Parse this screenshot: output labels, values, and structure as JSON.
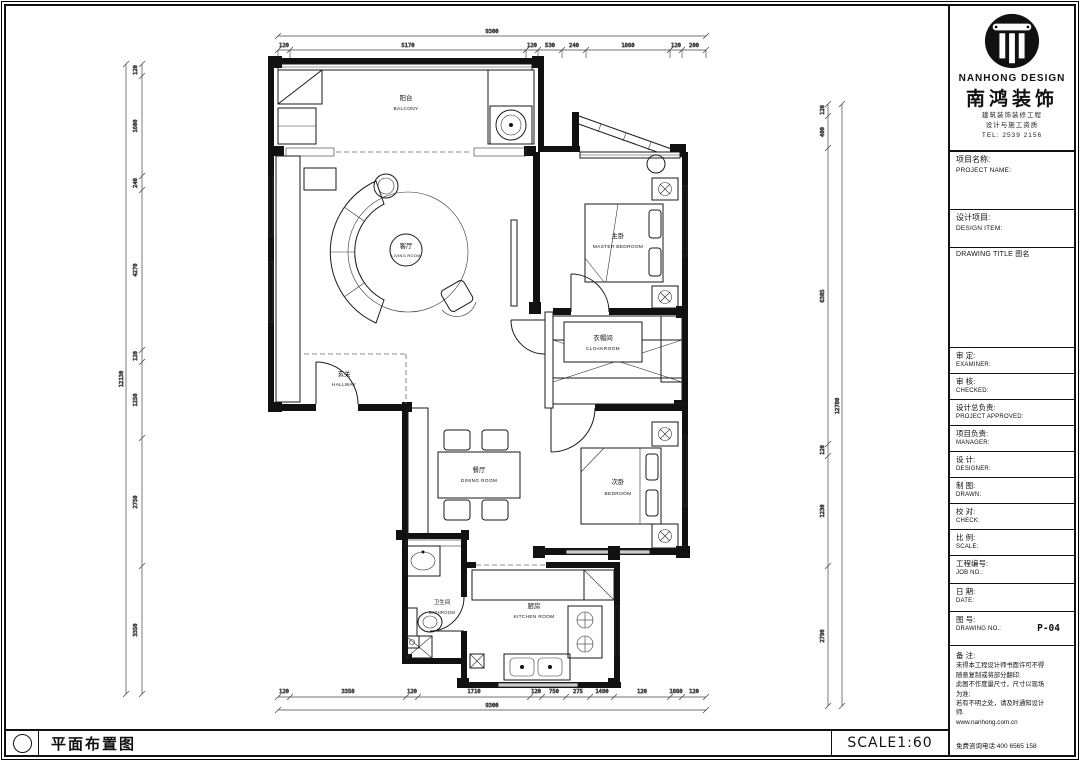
{
  "footer": {
    "drawing_title": "平面布置图",
    "scale": "SCALE1:60"
  },
  "brand": {
    "name_en": "NANHONG DESIGN",
    "name_cn": "南鸿装饰",
    "line1": "建筑装饰装修工程",
    "line2": "设计与施工资质",
    "line3": "TEL: 2539 2156"
  },
  "title_block": {
    "project_cn": "项目名称:",
    "project_en": "PROJECT NAME:",
    "design_cn": "设计项目:",
    "design_en": "DESIGN ITEM:",
    "drawing_title_label": "DRAWING TITLE 图名",
    "rows": [
      {
        "cn": "审  定:",
        "en": "EXAMINER:"
      },
      {
        "cn": "审  核:",
        "en": "CHECKED:"
      },
      {
        "cn": "设计总负责:",
        "en": "PROJECT APPROVED:"
      },
      {
        "cn": "项目负责:",
        "en": "MANAGER:"
      },
      {
        "cn": "设  计:",
        "en": "DESIGNER:"
      },
      {
        "cn": "制  图:",
        "en": "DRAWN:"
      },
      {
        "cn": "校  对:",
        "en": "CHECK:"
      },
      {
        "cn": "比  例:",
        "en": "SCALE:"
      },
      {
        "cn": "工程编号:",
        "en": "JOB NO.:"
      },
      {
        "cn": "日  期:",
        "en": "DATE:"
      },
      {
        "cn": "图  号:",
        "en": "DRAWING NO.:",
        "value": "P-04"
      }
    ],
    "notes_label": "备  注:",
    "notes": [
      "未得本工程设计师书面许可不得",
      "随意复制或将部分翻印;",
      "此图不作度量尺寸，尺寸以现场",
      "为准;",
      "若有不明之处，请及时通知设计",
      "师.",
      "www.nanhong.com.cn"
    ],
    "hotline": "免费咨询电话:400 6565 158"
  },
  "rooms": {
    "balcony": {
      "cn": "阳台",
      "en": "BALCONY"
    },
    "living": {
      "cn": "客厅",
      "en": "LIVING ROOM"
    },
    "master": {
      "cn": "主卧",
      "en": "MASTER BEDROOM"
    },
    "cloak": {
      "cn": "衣帽间",
      "en": "CLOAKROOM"
    },
    "hall": {
      "cn": "玄关",
      "en": "HALLWAY"
    },
    "dining": {
      "cn": "餐厅",
      "en": "DINING ROOM"
    },
    "bedroom": {
      "cn": "次卧",
      "en": "BEDROOM"
    },
    "bath": {
      "cn": "卫生间",
      "en": "BATHROOM"
    },
    "kitchen": {
      "cn": "厨房",
      "en": "KITCHEN ROOM"
    }
  },
  "dims": {
    "top": {
      "total": "9300",
      "segs": [
        "120",
        "5170",
        "120",
        "530",
        "240",
        "1860",
        "120",
        "200"
      ]
    },
    "bottom": {
      "total": "9300",
      "segs": [
        "120",
        "3350",
        "120",
        "1710",
        "120",
        "750",
        "275",
        "1490",
        "120",
        "1860",
        "120"
      ]
    },
    "left": {
      "total": "12130",
      "segs": [
        "120",
        "1600",
        "240",
        "4270",
        "120",
        "1250",
        "2750",
        "3350"
      ]
    },
    "right": {
      "total": "12780",
      "segs": [
        "120",
        "400",
        "6385",
        "120",
        "1230",
        "2790"
      ]
    }
  }
}
